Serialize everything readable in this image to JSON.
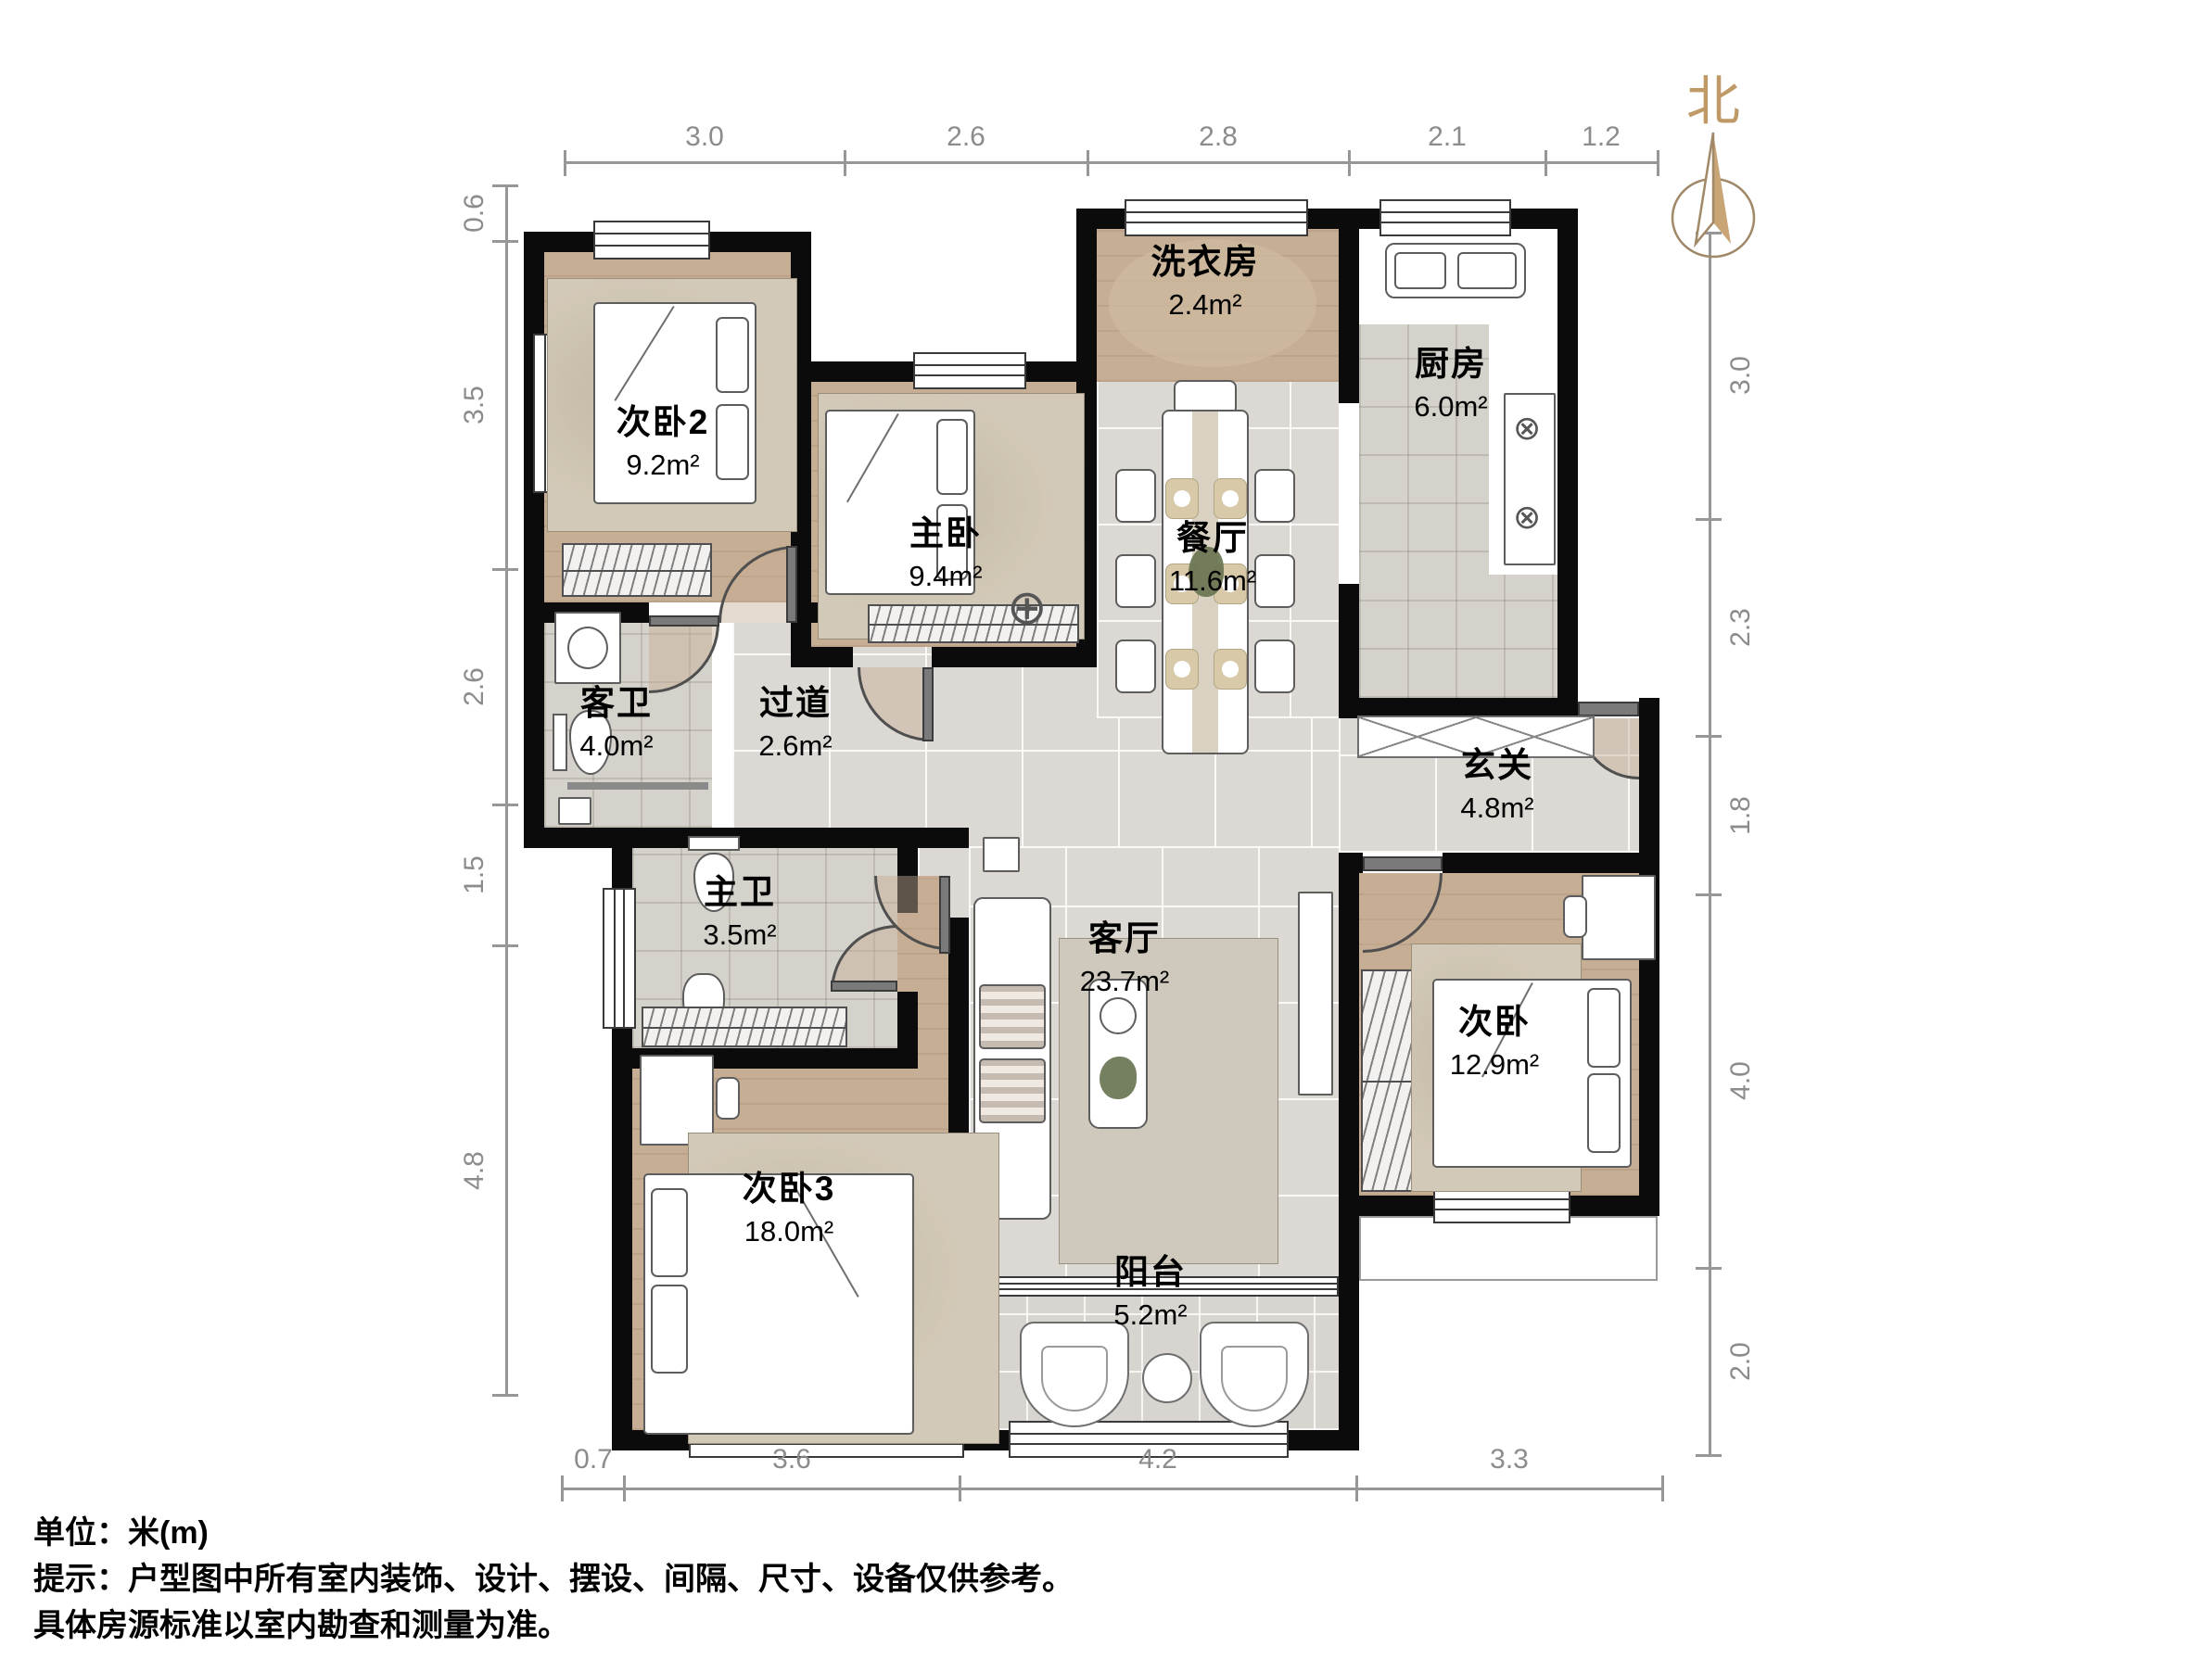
{
  "north": {
    "label": "北"
  },
  "dims": {
    "top": [
      "3.0",
      "2.6",
      "2.8",
      "2.1",
      "1.2"
    ],
    "left": [
      "0.6",
      "3.5",
      "2.6",
      "1.5",
      "4.8"
    ],
    "right": [
      "3.0",
      "2.3",
      "1.8",
      "4.0",
      "2.0"
    ],
    "bottom": [
      "0.7",
      "3.6",
      "4.2",
      "3.3"
    ]
  },
  "rooms": {
    "ciwo2": {
      "name": "次卧2",
      "area": "9.2m²"
    },
    "zhuwo": {
      "name": "主卧",
      "area": "9.4m²"
    },
    "xiyifang": {
      "name": "洗衣房",
      "area": "2.4m²"
    },
    "chufang": {
      "name": "厨房",
      "area": "6.0m²"
    },
    "canting": {
      "name": "餐厅",
      "area": "11.6m²"
    },
    "kewei": {
      "name": "客卫",
      "area": "4.0m²"
    },
    "guodao": {
      "name": "过道",
      "area": "2.6m²"
    },
    "xuanguan": {
      "name": "玄关",
      "area": "4.8m²"
    },
    "zhuwei": {
      "name": "主卫",
      "area": "3.5m²"
    },
    "keting": {
      "name": "客厅",
      "area": "23.7m²"
    },
    "ciwo": {
      "name": "次卧",
      "area": "12.9m²"
    },
    "ciwo3": {
      "name": "次卧3",
      "area": "18.0m²"
    },
    "yangtai": {
      "name": "阳台",
      "area": "5.2m²"
    }
  },
  "notes": {
    "line1": "单位：米(m)",
    "line2": "提示：户型图中所有室内装饰、设计、摆设、间隔、尺寸、设备仅供参考。",
    "line3": "具体房源标准以室内勘查和测量为准。"
  },
  "colors": {
    "wall": "#0b0b0b",
    "wood_floor": "#c6ae94",
    "marble_floor": "#dcd8d3",
    "tile_floor": "#d5d1cb",
    "dim_text": "#8c8c8c",
    "north_accent": "#bf9a67"
  }
}
